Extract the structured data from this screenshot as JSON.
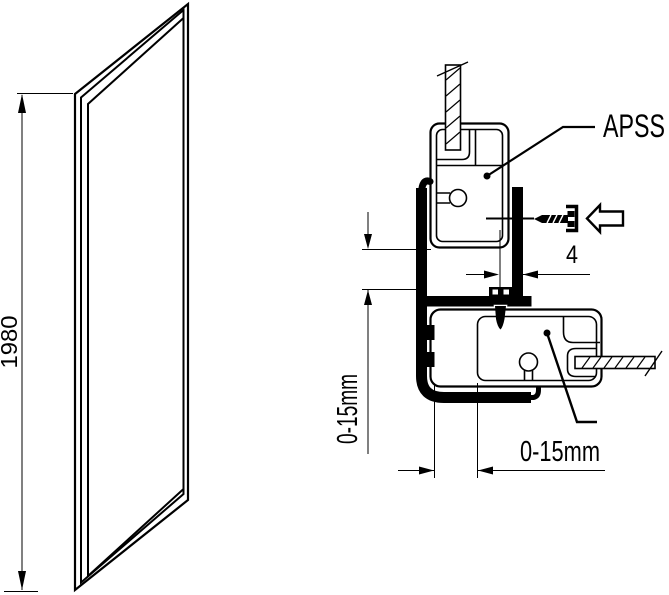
{
  "figure": {
    "type": "technical-installation-diagram",
    "colors": {
      "line": "#000000",
      "background": "#ffffff"
    },
    "labels": {
      "panel_height": "1980",
      "profile_name": "APSS",
      "screw_gap": "4",
      "vertical_adjustment": "0-15mm",
      "horizontal_adjustment": "0-15mm"
    },
    "icons": {
      "screw": "anchor-screw-icon",
      "insert_arrow": "insert-direction-arrow-icon"
    }
  }
}
